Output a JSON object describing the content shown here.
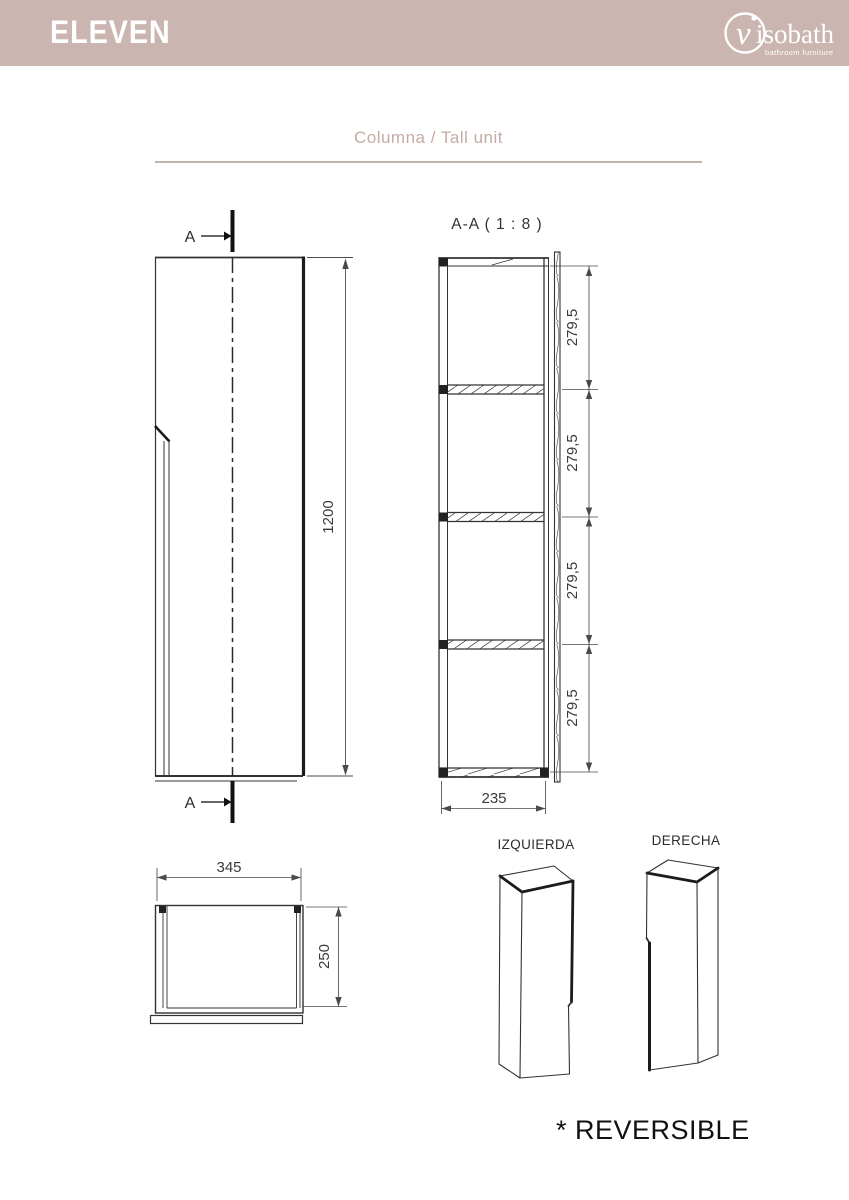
{
  "header": {
    "product_name": "ELEVEN",
    "brand_initial": "v",
    "brand_name": "isobath",
    "brand_tagline": "bathroom furniture",
    "band_color": "#cbb5b0"
  },
  "section_title": {
    "label": "Columna / Tall unit",
    "color": "#c5aba5"
  },
  "views": {
    "front": {
      "cut_label_top": "A",
      "cut_label_bottom": "A",
      "height_dim": "1200"
    },
    "section": {
      "label": "A-A ( 1 : 8 )",
      "shelf_heights": [
        "279,5",
        "279,5",
        "279,5",
        "279,5"
      ],
      "inner_width_dim": "235"
    },
    "plan": {
      "width_dim": "345",
      "depth_dim": "250"
    },
    "iso": {
      "left_label": "IZQUIERDA",
      "right_label": "DERECHA"
    },
    "note": "* REVERSIBLE"
  },
  "colors": {
    "line": "#333333",
    "accent_band": "#cbb5b0"
  }
}
